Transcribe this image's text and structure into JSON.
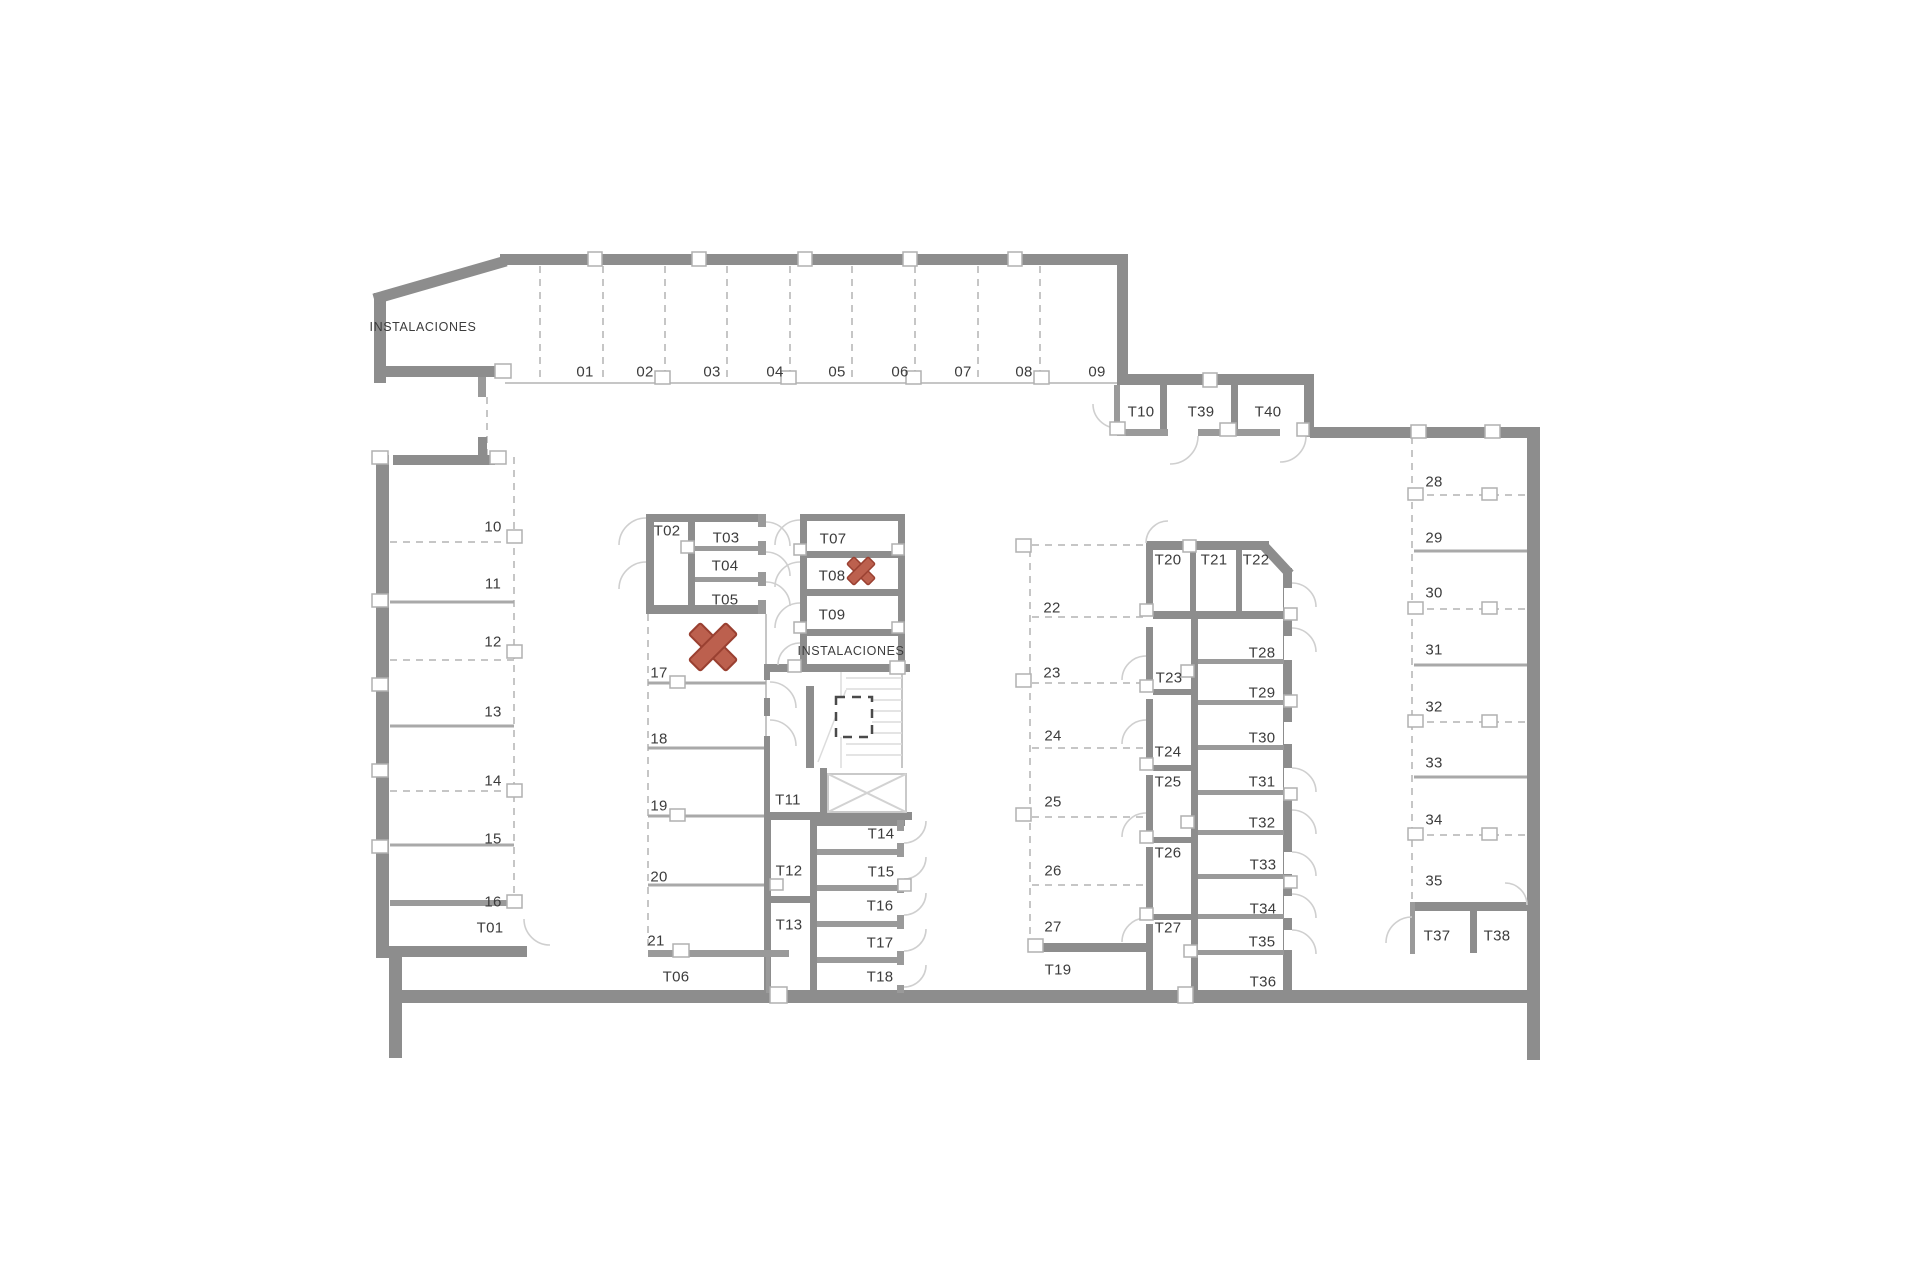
{
  "plan": {
    "title": "Trastero / parking floor plan",
    "wall_color": "#8d8d8d",
    "marker_color": "#bc604e",
    "marker_border": "#9a4031"
  },
  "labels": {
    "inst_top": "INSTALACIONES",
    "inst_mid": "INSTALACIONES",
    "s01": "01",
    "s02": "02",
    "s03": "03",
    "s04": "04",
    "s05": "05",
    "s06": "06",
    "s07": "07",
    "s08": "08",
    "s09": "09",
    "s10": "10",
    "s11": "11",
    "s12": "12",
    "s13": "13",
    "s14": "14",
    "s15": "15",
    "s16": "16",
    "s17": "17",
    "s18": "18",
    "s19": "19",
    "s20": "20",
    "s21": "21",
    "s22": "22",
    "s23": "23",
    "s24": "24",
    "s25": "25",
    "s26": "26",
    "s27": "27",
    "s28": "28",
    "s29": "29",
    "s30": "30",
    "s31": "31",
    "s32": "32",
    "s33": "33",
    "s34": "34",
    "s35": "35",
    "t01": "T01",
    "t02": "T02",
    "t03": "T03",
    "t04": "T04",
    "t05": "T05",
    "t06": "T06",
    "t07": "T07",
    "t08": "T08",
    "t09": "T09",
    "t10": "T10",
    "t11": "T11",
    "t12": "T12",
    "t13": "T13",
    "t14": "T14",
    "t15": "T15",
    "t16": "T16",
    "t17": "T17",
    "t18": "T18",
    "t19": "T19",
    "t20": "T20",
    "t21": "T21",
    "t22": "T22",
    "t23": "T23",
    "t24": "T24",
    "t25": "T25",
    "t26": "T26",
    "t27": "T27",
    "t28": "T28",
    "t29": "T29",
    "t30": "T30",
    "t31": "T31",
    "t32": "T32",
    "t33": "T33",
    "t34": "T34",
    "t35": "T35",
    "t36": "T36",
    "t37": "T37",
    "t38": "T38",
    "t39": "T39",
    "t40": "T40"
  }
}
